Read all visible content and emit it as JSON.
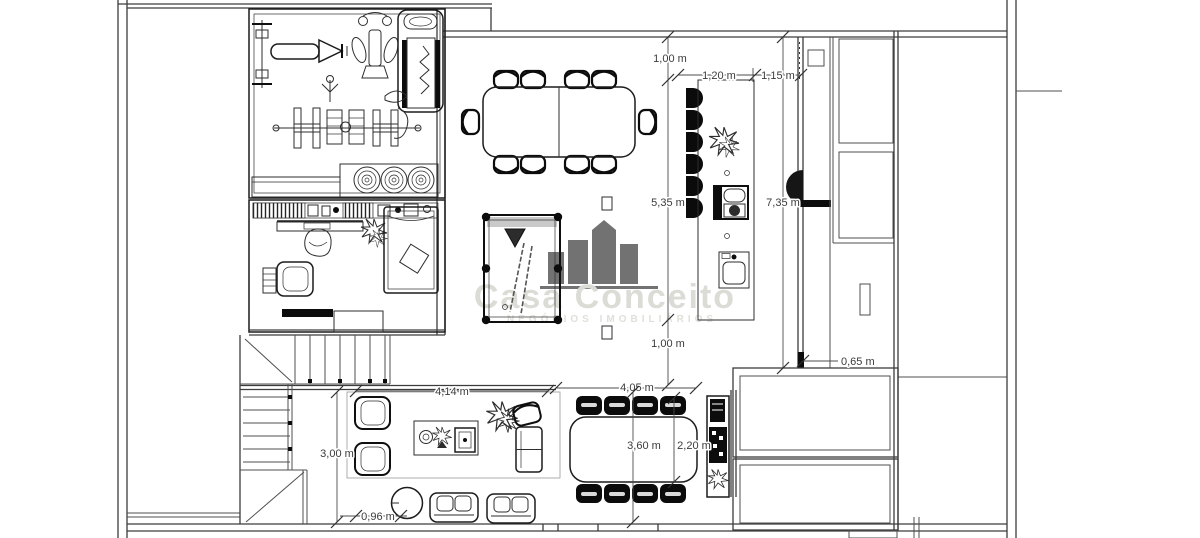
{
  "watermark": {
    "brand": "Casa Conceito",
    "tagline": "NEGÓCIOS IMOBILIÁRIOS"
  },
  "dims": {
    "island_top_gap": "1,00 m",
    "island_width": "1,20 m",
    "passage_width": "1,15 m",
    "island_length": "5,35 m",
    "room_length": "7,35 m",
    "island_bottom_gap": "1,00 m",
    "counter_gap": "0,65 m",
    "living_width": "4,14 m",
    "dining_width": "4,05 m",
    "living_depth": "3,00 m",
    "table_length": "3,60 m",
    "table_clearance": "2,20 m",
    "sofa_gap": "0,96 m"
  },
  "colors": {
    "wall": "#3c3c3c",
    "furniture_bold": "#0c0c0c",
    "dimension_text": "#3b3b3b",
    "watermark": "#dcdcd7",
    "pool_rail": "#c9c9c9",
    "background": "#ffffff"
  }
}
